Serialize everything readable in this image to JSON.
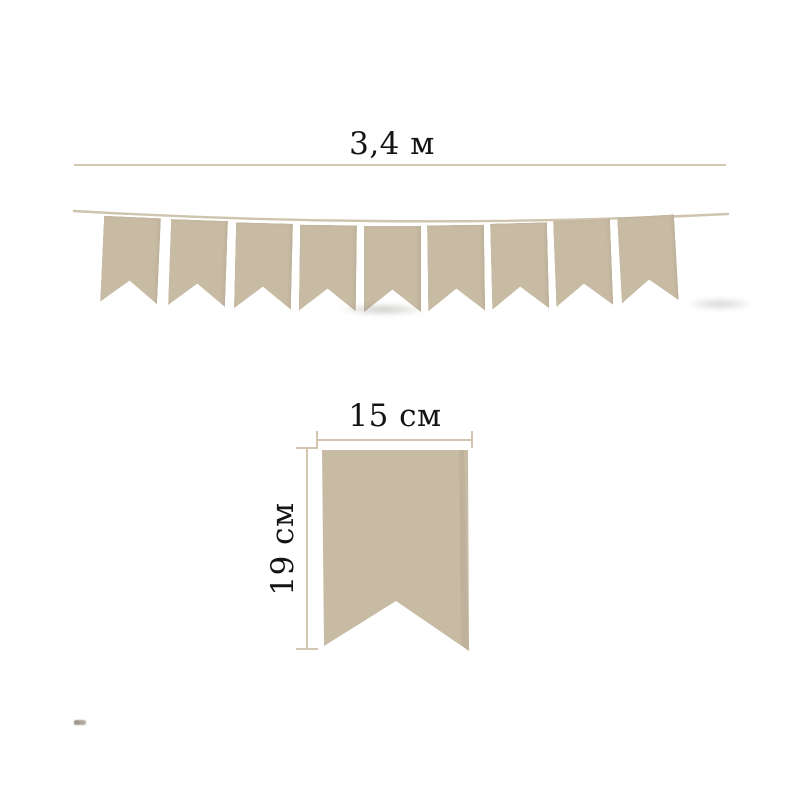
{
  "garland": {
    "length_label": "3,4 м",
    "flag_count": 9
  },
  "flag_detail": {
    "width_label": "15 см",
    "height_label": "19 см"
  },
  "colors": {
    "background": "#ffffff",
    "flag": "#c8bba4",
    "string": "#cfc4ad",
    "dimension_line": "#d2c6b0",
    "label_text": "#141414"
  }
}
